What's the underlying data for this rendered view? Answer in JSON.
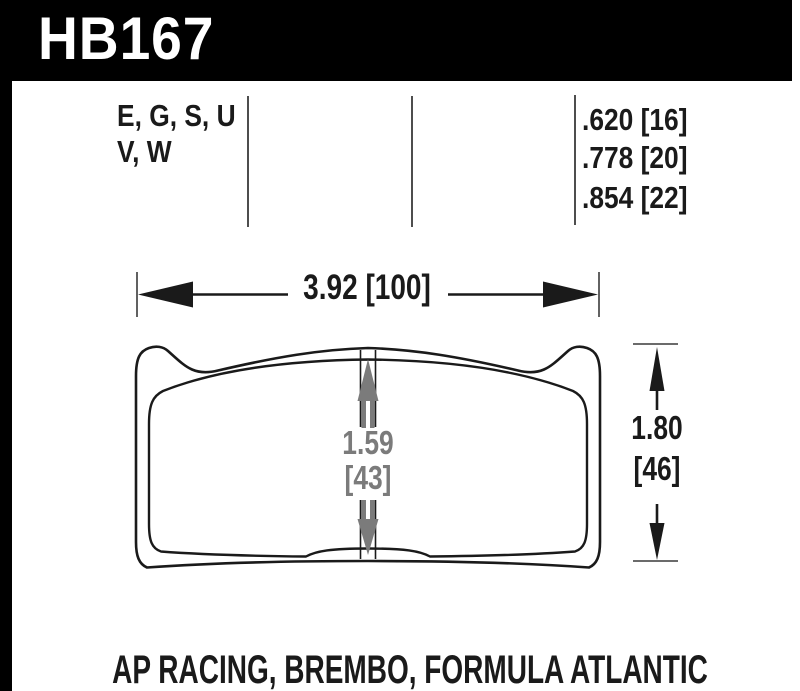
{
  "banner": {
    "part_number": "HB167"
  },
  "spec_row": {
    "compounds": {
      "line1": "E, G, S, U",
      "line2": "V, W"
    },
    "pad_thicknesses": [
      ".620 [16]",
      ".778 [20]",
      ".854 [22]"
    ]
  },
  "dimensions": {
    "width": "3.92 [100]",
    "pad_height": {
      "inches": "1.59",
      "millimeters": "[43]"
    },
    "overall_height": {
      "inches": "1.80",
      "millimeters": "[46]"
    }
  },
  "footer": {
    "applications": "AP RACING, BREMBO, FORMULA ATLANTIC"
  },
  "colors": {
    "banner_bg": "#000000",
    "line_black": "#1a1a1a",
    "dimension_gray": "#7b7b7b",
    "background": "#ffffff"
  }
}
